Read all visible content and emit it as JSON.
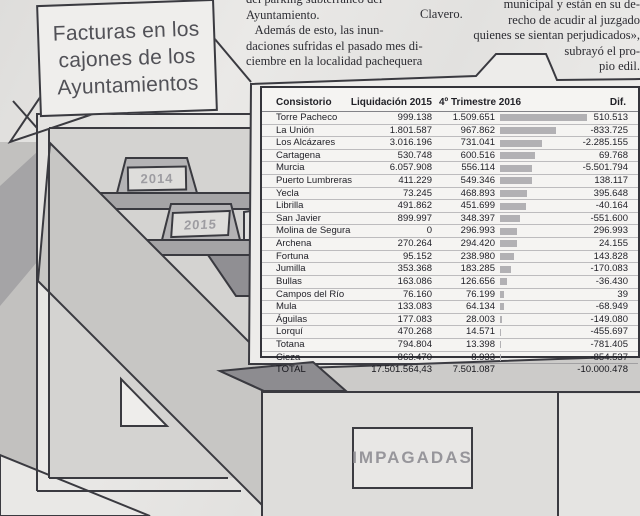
{
  "article": {
    "left_block": {
      "lines": [
        "del parking subterráneo del",
        "Ayuntamiento.",
        "   Además de esto, las inun-",
        "daciones sufridas el pasado mes di-",
        "ciembre en la localidad pachequera"
      ]
    },
    "byline": "Clavero.",
    "right_block": {
      "lines": [
        "municipal y están en su de-",
        "recho de acudir al juzgado",
        "quienes se sientan perjudicados»,",
        "subrayó el pro-",
        "pio edil."
      ]
    }
  },
  "title_card": {
    "lines": [
      "Facturas en los",
      "cajones de los",
      "Ayuntamientos"
    ]
  },
  "illustration": {
    "folder_tabs": [
      "2014",
      "2015"
    ],
    "drawer_label": "IMPAGADAS"
  },
  "table": {
    "headers": [
      "Consistorio",
      "Liquidación 2015",
      "4º Trimestre 2016",
      "Dif."
    ],
    "bar_max": 1509651,
    "bar_max_px": 87,
    "rows": [
      {
        "name": "Torre Pacheco",
        "liq": "999.138",
        "t4": "1.509.651",
        "dif": "510.513",
        "bar": 1509651
      },
      {
        "name": "La Unión",
        "liq": "1.801.587",
        "t4": "967.862",
        "dif": "-833.725",
        "bar": 967862
      },
      {
        "name": "Los Alcázares",
        "liq": "3.016.196",
        "t4": "731.041",
        "dif": "-2.285.155",
        "bar": 731041
      },
      {
        "name": "Cartagena",
        "liq": "530.748",
        "t4": "600.516",
        "dif": "69.768",
        "bar": 600516
      },
      {
        "name": "Murcia",
        "liq": "6.057.908",
        "t4": "556.114",
        "dif": "-5.501.794",
        "bar": 556114
      },
      {
        "name": "Puerto Lumbreras",
        "liq": "411.229",
        "t4": "549.346",
        "dif": "138.117",
        "bar": 549346
      },
      {
        "name": "Yecla",
        "liq": "73.245",
        "t4": "468.893",
        "dif": "395.648",
        "bar": 468893
      },
      {
        "name": "Librilla",
        "liq": "491.862",
        "t4": "451.699",
        "dif": "-40.164",
        "bar": 451699
      },
      {
        "name": "San Javier",
        "liq": "899.997",
        "t4": "348.397",
        "dif": "-551.600",
        "bar": 348397
      },
      {
        "name": "Molina de Segura",
        "liq": "0",
        "t4": "296.993",
        "dif": "296.993",
        "bar": 296993
      },
      {
        "name": "Archena",
        "liq": "270.264",
        "t4": "294.420",
        "dif": "24.155",
        "bar": 294420
      },
      {
        "name": "Fortuna",
        "liq": "95.152",
        "t4": "238.980",
        "dif": "143.828",
        "bar": 238980
      },
      {
        "name": "Jumilla",
        "liq": "353.368",
        "t4": "183.285",
        "dif": "-170.083",
        "bar": 183285
      },
      {
        "name": "Bullas",
        "liq": "163.086",
        "t4": "126.656",
        "dif": "-36.430",
        "bar": 126656
      },
      {
        "name": "Campos del Río",
        "liq": "76.160",
        "t4": "76.199",
        "dif": "39",
        "bar": 76199
      },
      {
        "name": "Mula",
        "liq": "133.083",
        "t4": "64.134",
        "dif": "-68.949",
        "bar": 64134
      },
      {
        "name": "Águilas",
        "liq": "177.083",
        "t4": "28.003",
        "dif": "-149.080",
        "bar": 28003
      },
      {
        "name": "Lorquí",
        "liq": "470.268",
        "t4": "14.571",
        "dif": "-455.697",
        "bar": 14571
      },
      {
        "name": "Totana",
        "liq": "794.804",
        "t4": "13.398",
        "dif": "-781.405",
        "bar": 13398
      },
      {
        "name": "Cieza",
        "liq": "863.470",
        "t4": "8.933",
        "dif": "-854.537",
        "bar": 8933
      }
    ],
    "total": {
      "name": "TOTAL",
      "liq": "17.501.564,43",
      "t4": "7.501.087",
      "dif": "-10.000.478"
    }
  },
  "chart_data": {
    "type": "bar",
    "title": "Facturas en los cajones de los Ayuntamientos",
    "categories": [
      "Torre Pacheco",
      "La Unión",
      "Los Alcázares",
      "Cartagena",
      "Murcia",
      "Puerto Lumbreras",
      "Yecla",
      "Librilla",
      "San Javier",
      "Molina de Segura",
      "Archena",
      "Fortuna",
      "Jumilla",
      "Bullas",
      "Campos del Río",
      "Mula",
      "Águilas",
      "Lorquí",
      "Totana",
      "Cieza"
    ],
    "series": [
      {
        "name": "Liquidación 2015",
        "values": [
          999138,
          1801587,
          3016196,
          530748,
          6057908,
          411229,
          73245,
          491862,
          899997,
          0,
          270264,
          95152,
          353368,
          163086,
          76160,
          133083,
          177083,
          470268,
          794804,
          863470
        ]
      },
      {
        "name": "4º Trimestre 2016",
        "values": [
          1509651,
          967862,
          731041,
          600516,
          556114,
          549346,
          468893,
          451699,
          348397,
          296993,
          294420,
          238980,
          183285,
          126656,
          76199,
          64134,
          28003,
          14571,
          13398,
          8933
        ]
      },
      {
        "name": "Dif.",
        "values": [
          510513,
          -833725,
          -2285155,
          69768,
          -5501794,
          138117,
          395648,
          -40164,
          -551600,
          296993,
          24155,
          143828,
          -170083,
          -36430,
          39,
          -68949,
          -149080,
          -455697,
          -781405,
          -854537
        ]
      }
    ],
    "totals": {
      "liquidacion_2015": "17.501.564,43",
      "trimestre4_2016": 7501087,
      "dif": -10000478
    },
    "bars_shown_for_series": "4º Trimestre 2016",
    "legend_position": "none",
    "grid": false
  }
}
